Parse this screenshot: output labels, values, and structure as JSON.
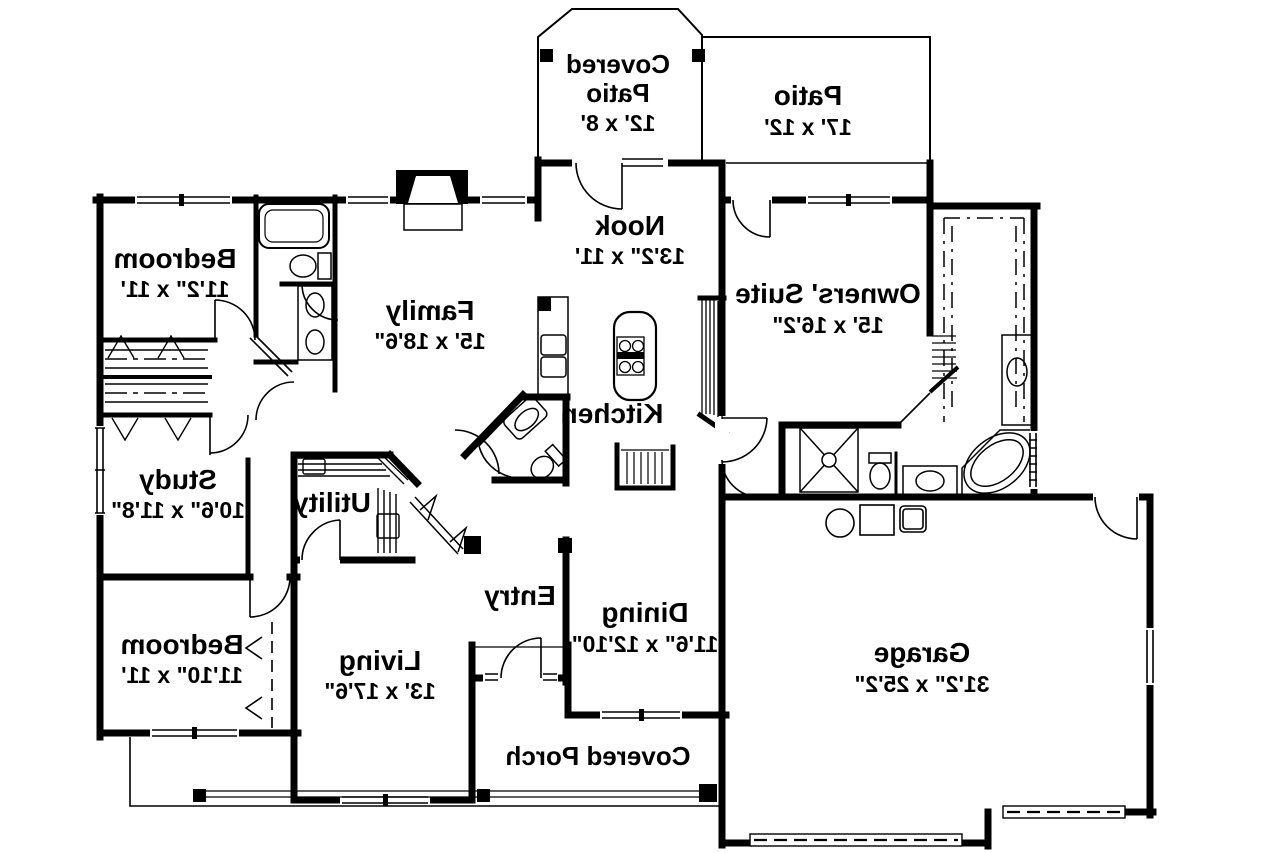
{
  "plan": {
    "type": "floor-plan",
    "note": "single-story house plan, mirrored (reversed) text",
    "colors": {
      "wall": "#000000",
      "background": "#ffffff"
    },
    "rooms": [
      {
        "line1": "Covered",
        "line2": "Patio",
        "dims": "12' x 8'"
      },
      {
        "line1": "Patio",
        "dims": "17' x 12'"
      },
      {
        "line1": "Nook",
        "dims": "13'2\" x 11'"
      },
      {
        "line1": "Family",
        "dims": "15' x 18'6\""
      },
      {
        "line1": "Owners' Suite",
        "dims": "15' x 16'2\""
      },
      {
        "line1": "Bedroom",
        "dims": "11'2\" x 11'"
      },
      {
        "line1": "Study",
        "dims": "10'6\" x 11'8\""
      },
      {
        "line1": "Bedroom",
        "dims": "11'10\" x 11'"
      },
      {
        "line1": "Utility",
        "dims": ""
      },
      {
        "line1": "Kitchen",
        "dims": ""
      },
      {
        "line1": "Living",
        "dims": "13' x 17'6\""
      },
      {
        "line1": "Entry",
        "dims": ""
      },
      {
        "line1": "Dining",
        "dims": "11'6\" x 12'10\""
      },
      {
        "line1": "Garage",
        "dims": "31'2\" x 25'2\""
      },
      {
        "line1": "Covered Porch",
        "dims": ""
      }
    ]
  }
}
